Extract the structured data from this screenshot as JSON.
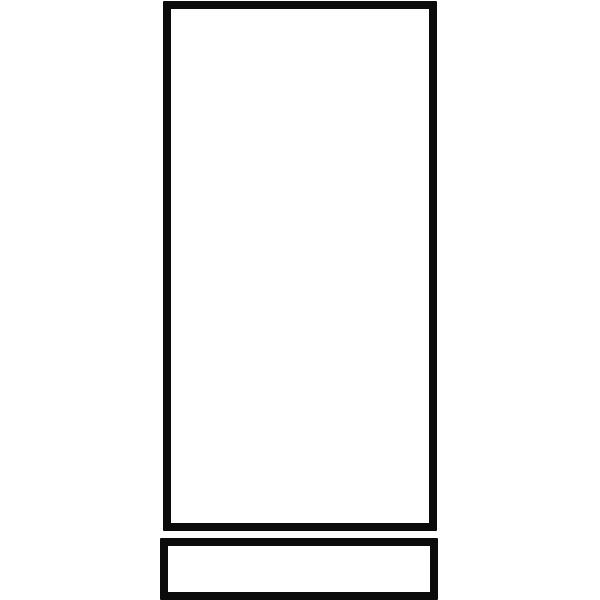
{
  "canvas": {
    "width": 600,
    "height": 600,
    "background": "#ffffff"
  },
  "drawing": {
    "description": "Black-and-white clipart line drawing: a tall empty rectangle outline with a short wide rectangle outline directly below it, touching the bottom edge of the image",
    "stroke_color": "#0b0b0b",
    "fill_color": "#ffffff",
    "shapes": {
      "tall_rectangle": {
        "left": 163,
        "top": 1,
        "width": 274,
        "height": 530,
        "stroke_width": 8
      },
      "base_rectangle": {
        "left": 160,
        "top": 538,
        "width": 278,
        "height": 62,
        "stroke_width": 8
      }
    }
  }
}
